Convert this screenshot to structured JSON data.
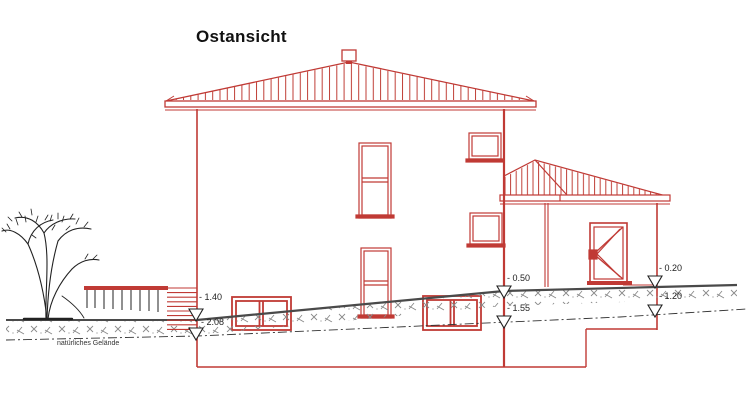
{
  "title": "Ostansicht",
  "drawing": {
    "type": "building-elevation-east-view",
    "terrain_label": "natürliches Gelände",
    "levels": {
      "main_left_upper": "- 1.40",
      "main_left_lower": "- 2.08",
      "main_right_upper": "- 0.50",
      "main_right_lower": "- 1.55",
      "annex_right_upper": "- 0.20",
      "annex_right_lower": "- 1.20"
    },
    "colors": {
      "building_red": "#c03a35",
      "terrain_gray": "#4a4a4a",
      "text_black": "#1c1c1c"
    }
  }
}
